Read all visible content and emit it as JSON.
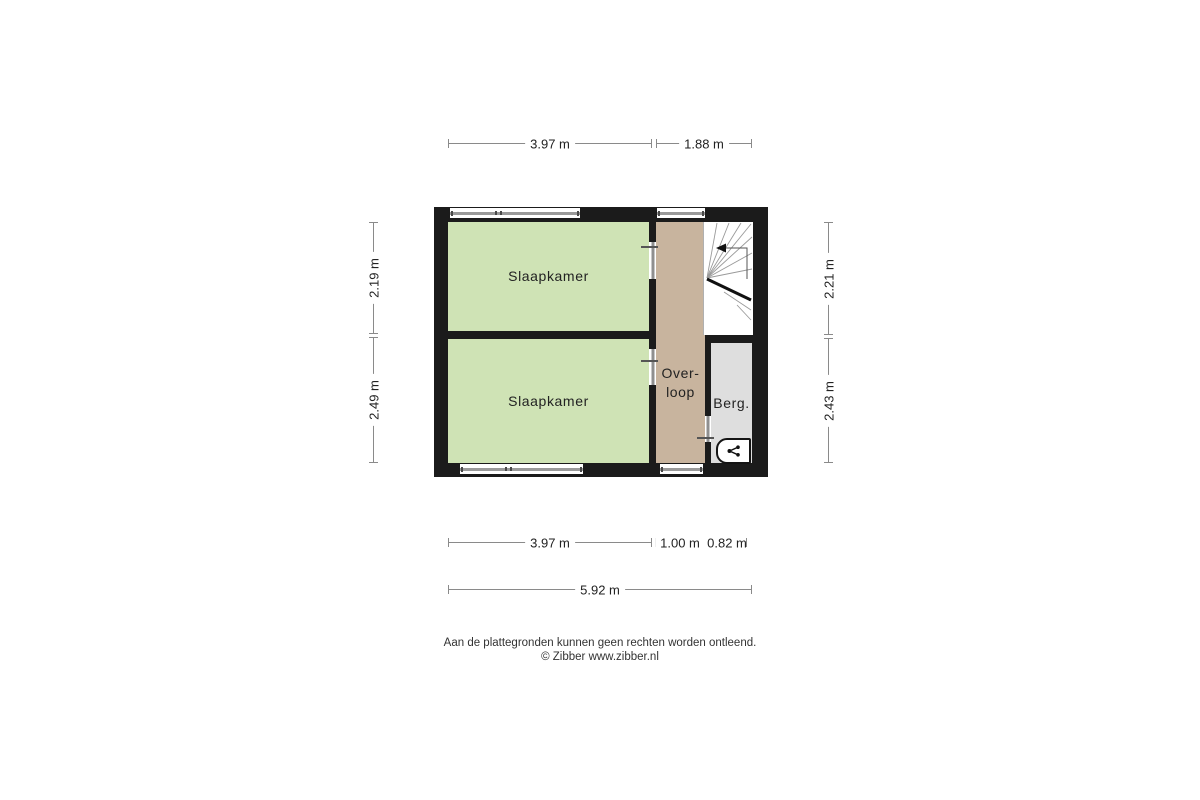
{
  "page": {
    "background": "#ffffff",
    "type": "floor-plan"
  },
  "colors": {
    "wall": "#1b1b1b",
    "bedroom_fill": "#cfe3b5",
    "hallway_fill": "#c8b49e",
    "storage_fill": "#dedede",
    "stairs_fill": "#ffffff",
    "dimension_line": "#8a8a8a",
    "window_line": "#9a9a9a",
    "text": "#222222"
  },
  "plan": {
    "rooms": [
      {
        "id": "slaapkamer-1",
        "label": "Slaapkamer"
      },
      {
        "id": "slaapkamer-2",
        "label": "Slaapkamer"
      },
      {
        "id": "overloop",
        "label_line1": "Over-",
        "label_line2": "loop"
      },
      {
        "id": "berging",
        "label": "Berg."
      }
    ],
    "features": [
      {
        "id": "stairs",
        "name": "winder-staircase"
      },
      {
        "id": "mv-unit",
        "name": "mechanical-ventilation-icon"
      }
    ]
  },
  "dimensions": {
    "top": [
      {
        "label": "3.97 m"
      },
      {
        "label": "1.88 m"
      }
    ],
    "left": [
      {
        "label": "2.19 m"
      },
      {
        "label": "2.49 m"
      }
    ],
    "right": [
      {
        "label": "2.21 m"
      },
      {
        "label": "2.43 m"
      }
    ],
    "bottom_row1": [
      {
        "label": "3.97 m"
      },
      {
        "label": "1.00 m"
      },
      {
        "label": "0.82 m"
      }
    ],
    "bottom_row2": [
      {
        "label": "5.92 m"
      }
    ]
  },
  "footer": {
    "disclaimer": "Aan de plattegronden kunnen geen rechten worden ontleend.",
    "copyright": "© Zibber www.zibber.nl"
  }
}
